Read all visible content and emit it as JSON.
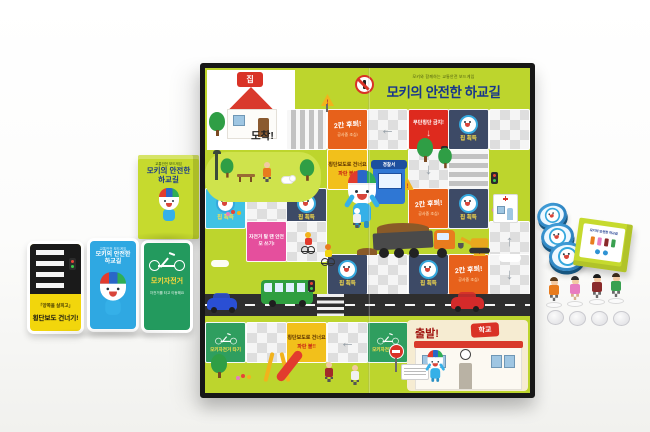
{
  "board": {
    "subtitle": "모키와 함께하는 교통안전 보드게임",
    "title": "모키의 안전한 하교길",
    "arrive_label": "도착!",
    "start_label": "출발!",
    "home_sign": "집",
    "school_sign": "학교",
    "police_sign": "경찰서",
    "tiles": {
      "chip_gain": "칩 획득",
      "move_back_2": "2칸 후퇴!",
      "construction_caution": "공사중 조심!",
      "no_jaywalking": "무단횡단 금지!",
      "crosswalk_line1": "횡단보도로 건너요",
      "crosswalk_line2": "파란 불!!",
      "helmet_rule": "자전거 탈 땐 안전모 쓰기!",
      "bike_ride": "모키자전거 타기"
    },
    "colors": {
      "board_green": "#bdd52d",
      "tile_cyan": "#3fc2e4",
      "tile_navy": "#3d4a66",
      "tile_orange": "#e7611b",
      "tile_red": "#de2a1e",
      "tile_yellow": "#f2c01b",
      "tile_pink": "#e54f9d",
      "tile_green": "#2f9e5f",
      "chip_blue": "#2f93d4",
      "title_blue": "#17368c"
    }
  },
  "cards": {
    "box": {
      "tagline": "교통안전 보드게임",
      "title_line1": "모키의 안전한",
      "title_line2": "하교길"
    },
    "crosswalk_card": {
      "caption": "「양쪽을 살피고」",
      "title": "횡단보도 건너기!"
    },
    "back_card": {
      "tagline": "교통안전 보드게임",
      "title_line1": "모키의 안전한",
      "title_line2": "하교길"
    },
    "bike_card": {
      "title": "모키자전거",
      "caption": "자전거를 타고 이동해요"
    }
  },
  "pieces": {
    "box_label": "모키의 안전한 하교길"
  }
}
